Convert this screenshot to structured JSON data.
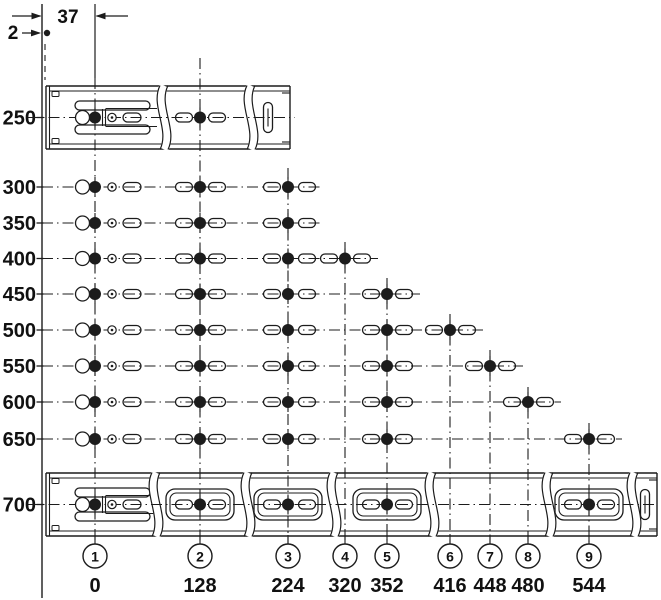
{
  "diagram": {
    "background": "#ffffff",
    "line_color": "#1c1c1c",
    "top_dimensions": {
      "width": "37",
      "offset": "2"
    },
    "axis": {
      "x": 42,
      "top": 4,
      "bottom": 598
    },
    "rows": [
      {
        "length": "250",
        "y": 117.5,
        "holes": [
          1,
          2
        ],
        "rail": "top"
      },
      {
        "length": "300",
        "y": 187,
        "holes": [
          1,
          2,
          3
        ]
      },
      {
        "length": "350",
        "y": 223,
        "holes": [
          1,
          2,
          3
        ]
      },
      {
        "length": "400",
        "y": 258.5,
        "holes": [
          1,
          2,
          3,
          4
        ]
      },
      {
        "length": "450",
        "y": 294,
        "holes": [
          1,
          2,
          3,
          5
        ]
      },
      {
        "length": "500",
        "y": 330,
        "holes": [
          1,
          2,
          3,
          5,
          6
        ]
      },
      {
        "length": "550",
        "y": 366,
        "holes": [
          1,
          2,
          3,
          5,
          7
        ]
      },
      {
        "length": "600",
        "y": 402,
        "holes": [
          1,
          2,
          3,
          5,
          8
        ]
      },
      {
        "length": "650",
        "y": 439,
        "holes": [
          1,
          2,
          3,
          5,
          9
        ]
      },
      {
        "length": "700",
        "y": 504.5,
        "holes": [
          1,
          2,
          3,
          5,
          9
        ],
        "rail": "bottom"
      }
    ],
    "positions": [
      {
        "number": "1",
        "dimension": "0",
        "x": 95,
        "line_top": 4
      },
      {
        "number": "2",
        "dimension": "128",
        "x": 200,
        "line_top": 58
      },
      {
        "number": "3",
        "dimension": "224",
        "x": 288,
        "line_top": 168
      },
      {
        "number": "4",
        "dimension": "320",
        "x": 345,
        "line_top": 242
      },
      {
        "number": "5",
        "dimension": "352",
        "x": 387,
        "line_top": 278
      },
      {
        "number": "6",
        "dimension": "416",
        "x": 450,
        "line_top": 314
      },
      {
        "number": "7",
        "dimension": "448",
        "x": 490,
        "line_top": 350
      },
      {
        "number": "8",
        "dimension": "480",
        "x": 528,
        "line_top": 387
      },
      {
        "number": "9",
        "dimension": "544",
        "x": 589,
        "line_top": 423
      }
    ],
    "rails": {
      "top": {
        "cy": 117.5,
        "x_left": 46,
        "x_right": 290,
        "breaks": [
          160,
          247
        ],
        "frames": [],
        "cap_slot_x": 268
      },
      "bottom": {
        "cy": 504.5,
        "x_left": 46,
        "x_right": 657,
        "breaks": [
          152,
          244,
          330,
          428,
          545,
          630
        ],
        "frames": [
          200,
          288,
          387,
          589
        ],
        "cap_slot_x": 645
      }
    }
  }
}
